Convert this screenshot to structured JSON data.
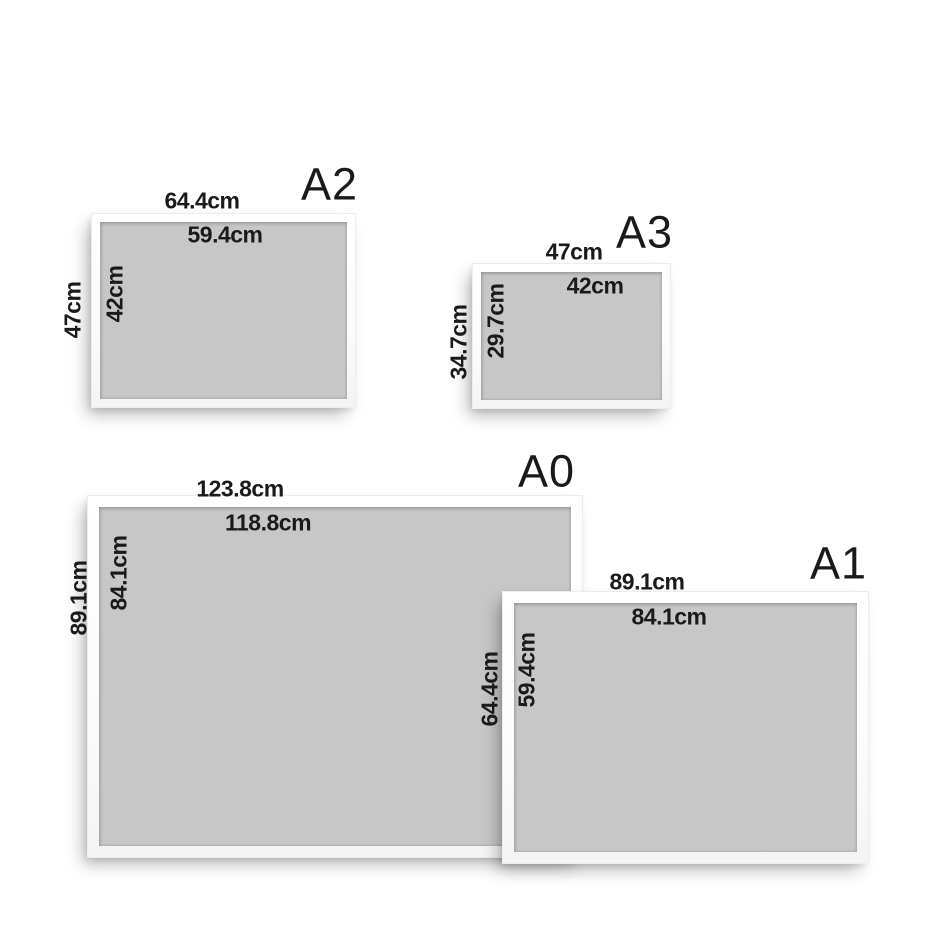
{
  "colors": {
    "background": "#ffffff",
    "frame": "#ffffff",
    "mat_gray": "#c7c7c7",
    "text": "#1a1a1a"
  },
  "frames": [
    {
      "name": "A2",
      "outer_width": "64.4cm",
      "inner_width": "59.4cm",
      "outer_height": "47cm",
      "inner_height": "42cm"
    },
    {
      "name": "A3",
      "outer_width": "47cm",
      "inner_width": "42cm",
      "outer_height": "34.7cm",
      "inner_height": "29.7cm"
    },
    {
      "name": "A0",
      "outer_width": "123.8cm",
      "inner_width": "118.8cm",
      "outer_height": "89.1cm",
      "inner_height": "84.1cm"
    },
    {
      "name": "A1",
      "outer_width": "89.1cm",
      "inner_width": "84.1cm",
      "outer_height": "64.4cm",
      "inner_height": "59.4cm"
    }
  ]
}
